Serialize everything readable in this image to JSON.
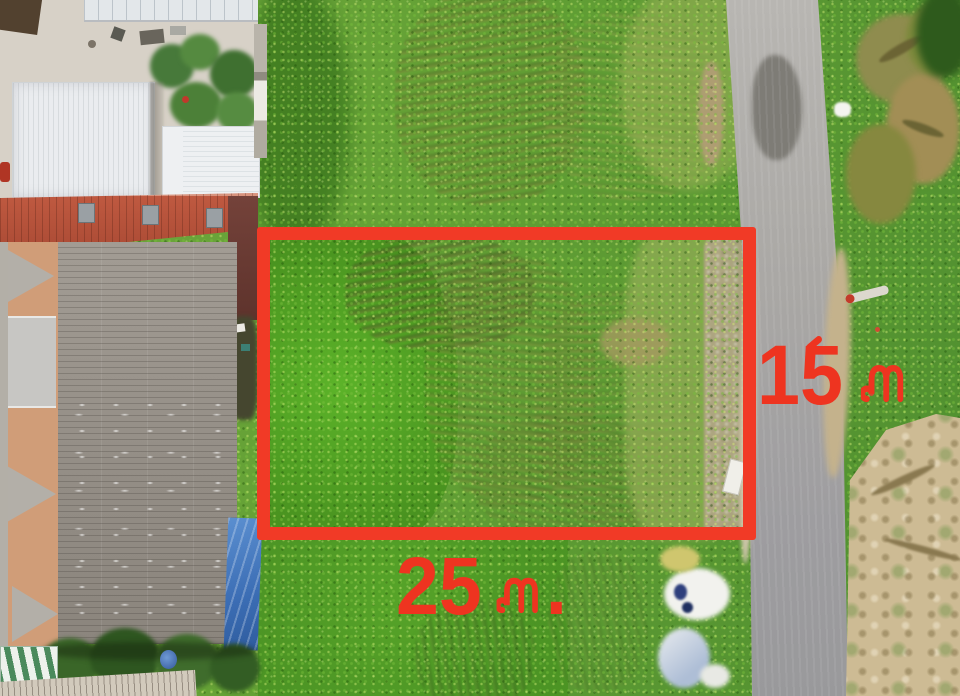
{
  "scene": {
    "type": "aerial-land-plot-photo",
    "description": "Top-down drone photograph of a rectangular vacant grass plot outlined with a red boundary rectangle, flanked by house roofs on the left and a concrete road on the right, with dimension labels in Thai meters",
    "labels": {
      "width_label": "25 ม.",
      "width_number": "25",
      "width_period": ".",
      "depth_label": "15 ม",
      "depth_number": "15",
      "unit_thai": "ม"
    },
    "colors": {
      "annotation_red": "#f13a26",
      "label_red": "#ee3420",
      "grass_green": "#6ca23c",
      "clover_green": "#55a428",
      "tall_grass_olive": "#8d9c4a",
      "road_gray": "#a8a6a3",
      "dry_ground_tan": "#cdbb94",
      "gray_roof": "#98928a",
      "red_roof": "#b45138",
      "white_roof": "#e7eaec",
      "tarp_blue": "#3f72b8"
    }
  }
}
